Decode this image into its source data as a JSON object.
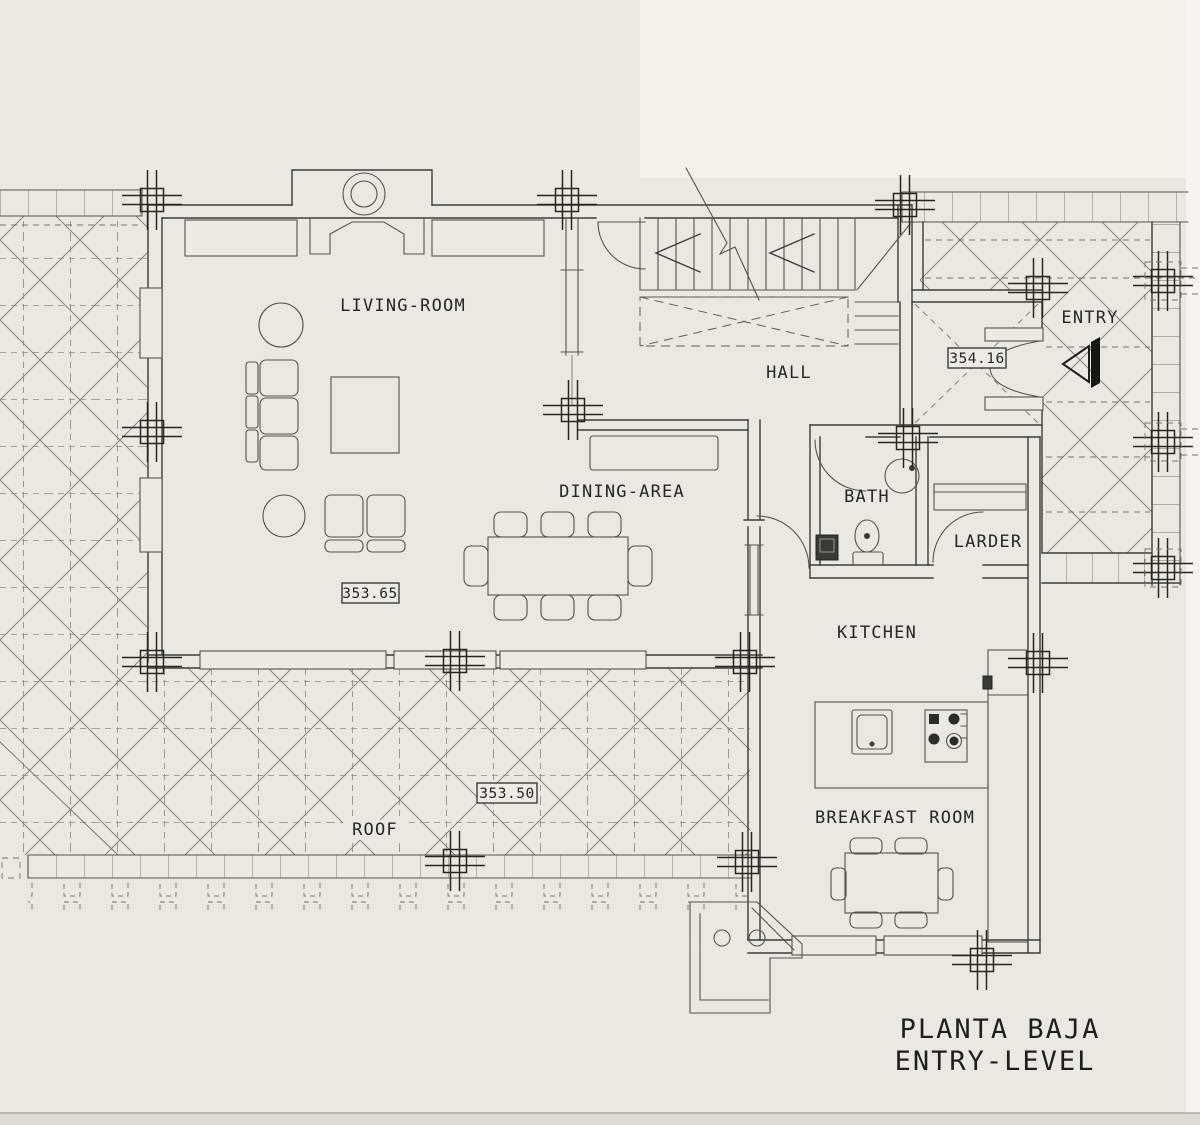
{
  "plan": {
    "title_line1": "PLANTA BAJA",
    "title_line2": "ENTRY-LEVEL",
    "rooms": {
      "living_room": "LIVING-ROOM",
      "hall": "HALL",
      "entry": "ENTRY",
      "dining_area": "DINING-AREA",
      "bath": "BATH",
      "larder": "LARDER",
      "kitchen": "KITCHEN",
      "breakfast_room": "BREAKFAST ROOM",
      "roof": "ROOF"
    },
    "levels": {
      "living_room": "353.65",
      "roof": "353.50",
      "entry": "354.16"
    },
    "colors": {
      "paper": "#e9e8e1",
      "ink": "#3d3d38",
      "light_ink": "#74746c"
    }
  }
}
